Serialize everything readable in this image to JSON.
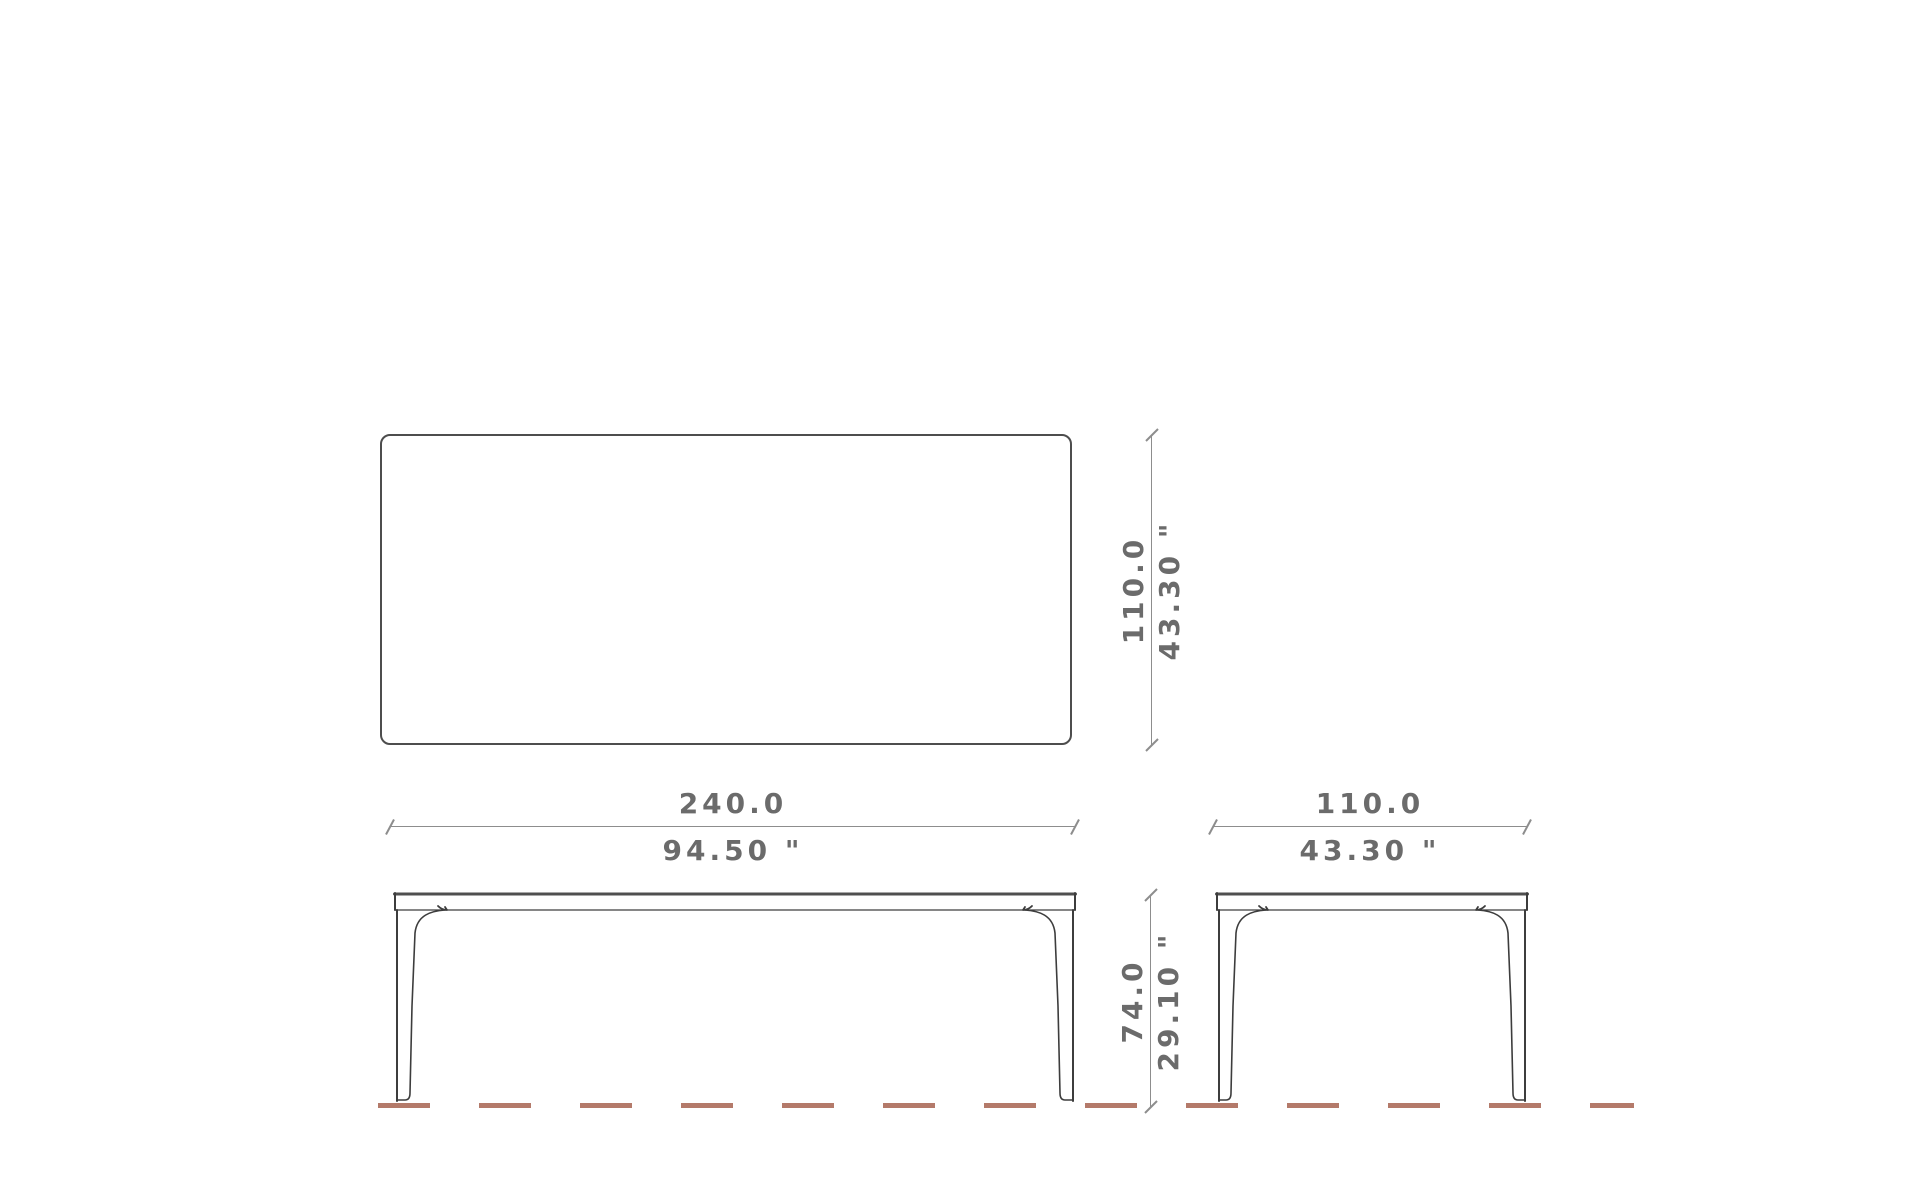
{
  "drawing": {
    "dimensions": {
      "depth_top": {
        "metric": "110.0",
        "imperial": "43.30 \""
      },
      "width_front": {
        "metric": "240.0",
        "imperial": "94.50 \""
      },
      "depth_side": {
        "metric": "110.0",
        "imperial": "43.30 \""
      },
      "height": {
        "metric": "74.0",
        "imperial": "29.10 \""
      }
    },
    "colors": {
      "outline": "#3d3d3d",
      "top_edge": "#4f4f4f",
      "dimension_line": "#8d8d8d",
      "dimension_text": "#6b6b6b",
      "ground_line": "#b47a6a"
    }
  }
}
